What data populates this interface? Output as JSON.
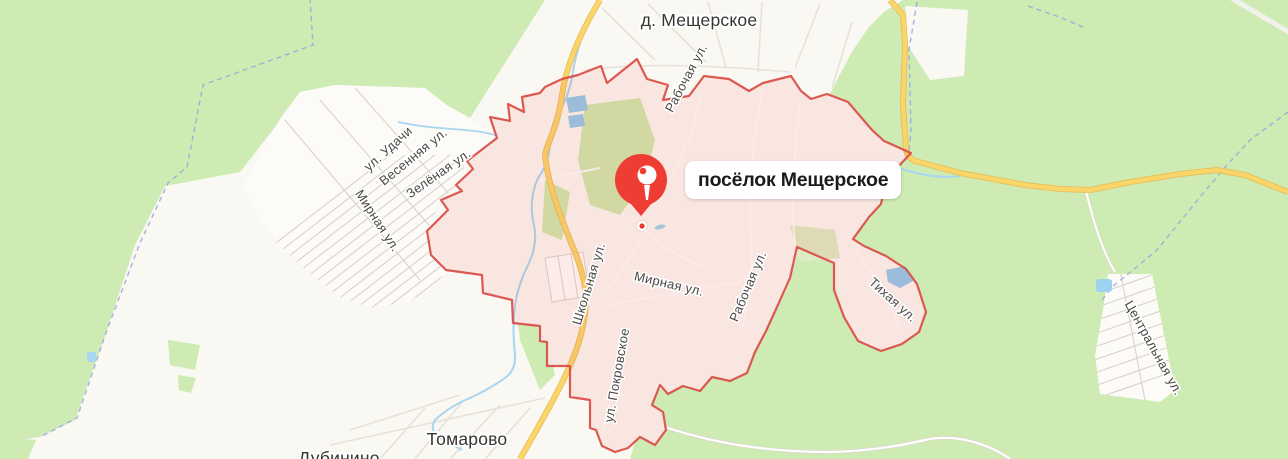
{
  "map": {
    "selected_place": {
      "label": "посёлок Мещерское"
    },
    "place_labels": {
      "village_top": "д. Мещерское",
      "tomarovo": "Томарово",
      "dubinino": "Дубинино"
    },
    "street_labels": {
      "rabochaya_top": "Рабочая ул.",
      "udachi": "ул. Удачи",
      "vesennyaya": "Весенняя ул.",
      "zelyonaya": "Зелёная ул.",
      "mirnaya_left": "Мирная ул.",
      "shkolnaya": "Школьная ул.",
      "mirnaya_center": "Мирная ул.",
      "rabochaya_center": "Рабочая ул.",
      "pokrovskoye": "ул. Покровское",
      "tikhaya": "Тихая ул.",
      "tsentralnaya": "Центральная ул."
    },
    "colors": {
      "forest": "#cdebb2",
      "field": "#faf8f3",
      "water": "#9fd0ef",
      "road_yellow": "#f9d56a",
      "region_stroke": "#da5149",
      "region_fill": "rgba(230,90,80,0.13)",
      "pin_red": "#ee3d33",
      "boundary_blue": "#98a6df"
    }
  }
}
